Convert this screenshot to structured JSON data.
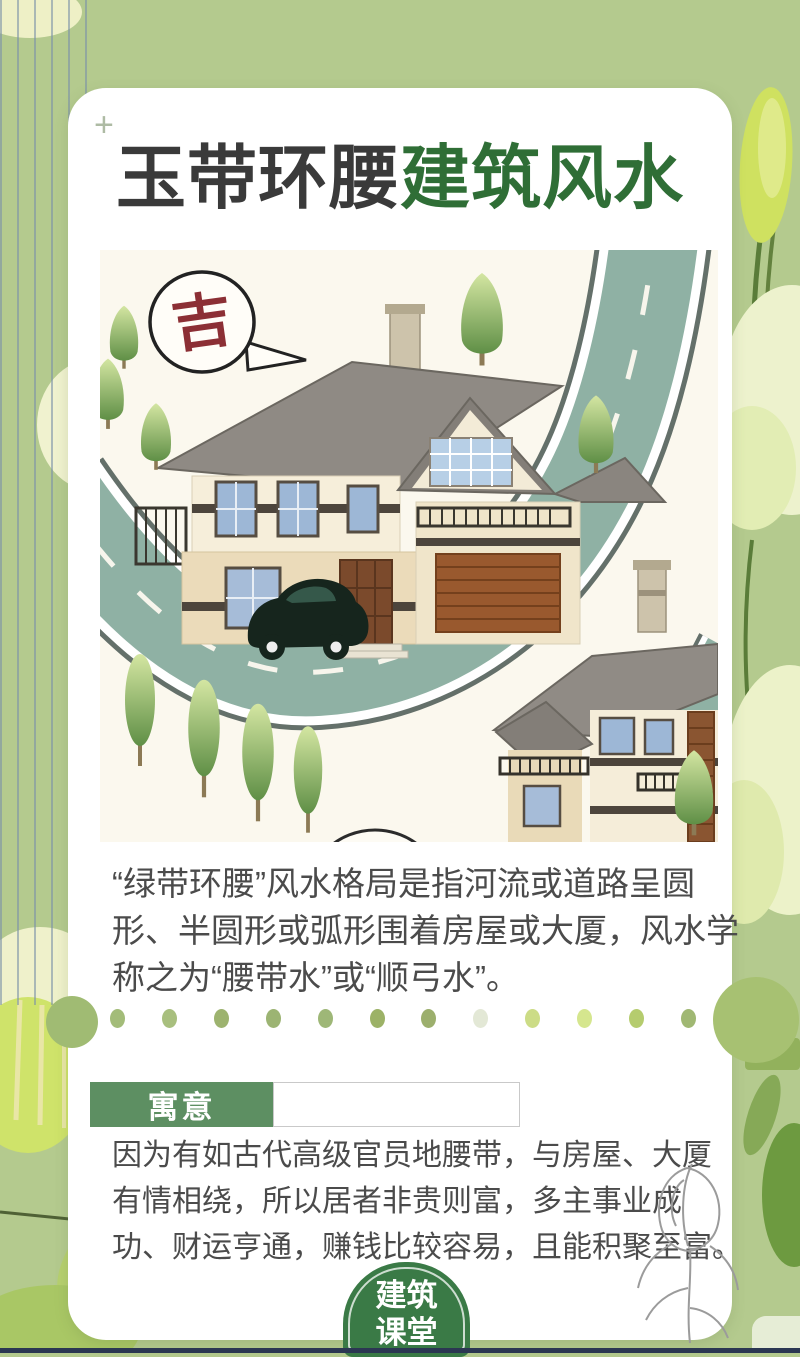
{
  "header": {
    "plus_mark": "+",
    "title_dark": "玉带环腰",
    "title_green": "建筑风水"
  },
  "illustration": {
    "bubble_char": "吉",
    "icon_names": [
      "speech-bubble-icon",
      "villa-house",
      "winding-road",
      "car-icon",
      "tree-icon",
      "apartment-house"
    ]
  },
  "paragraph1": {
    "lines": [
      "“绿带环腰”风水格局是指河流或道路呈圆",
      "形、半圆形或弧形围着房屋或大厦，风水学",
      "称之为“腰带水”或“顺弓水”。"
    ]
  },
  "meaning": {
    "label": "寓意",
    "lines": [
      "因为有如古代高级官员地腰带，与房屋、大厦",
      "有情相绕，所以居者非贵则富，多主事业成",
      "功、财运亨通，赚钱比较容易，且能积聚至富。"
    ]
  },
  "badge": {
    "line1": "建筑",
    "line2": "课堂"
  },
  "dots": {
    "colors": [
      "#a3bc79",
      "#a8bf7e",
      "#9db36f",
      "#9cb473",
      "#9eb777",
      "#9cb267",
      "#9caf6d",
      "#e3e8d6",
      "#ccdc86",
      "#d5e68e",
      "#b5cc6e",
      "#a0b873"
    ]
  },
  "colors": {
    "background_green": "#b4ca8e",
    "title_green": "#2f6e36",
    "meaning_tag_green": "#5d8f62",
    "badge_green": "#3a7a46",
    "road_teal": "#8fb1a4",
    "bubble_char_red": "#8c2f35",
    "body_text": "#4b4b4b",
    "bottom_strip_navy": "#2b3752"
  }
}
